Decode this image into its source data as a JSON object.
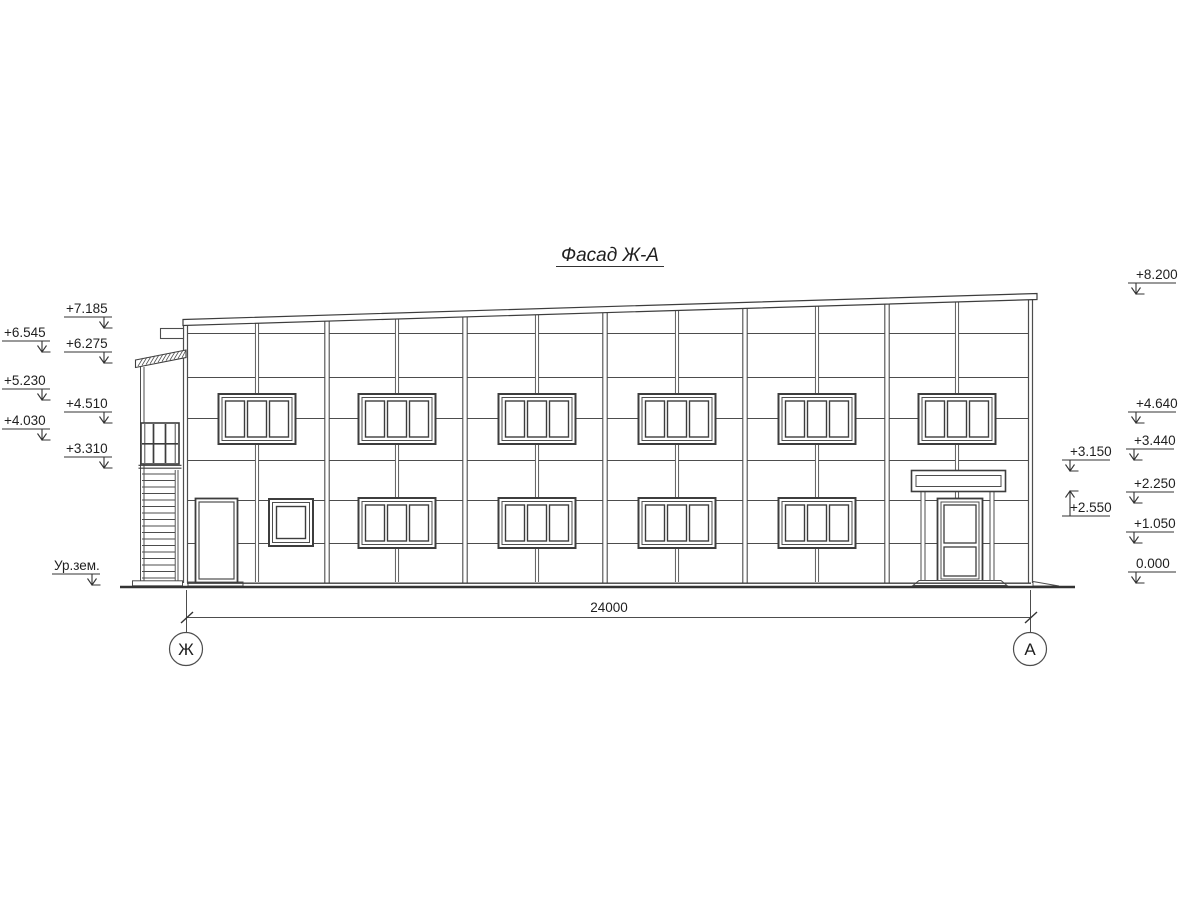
{
  "title": {
    "text": "Фасад Ж-А"
  },
  "left_marks": [
    {
      "label": "+7.185"
    },
    {
      "label": "+6.545"
    },
    {
      "label": "+6.275"
    },
    {
      "label": "+5.230"
    },
    {
      "label": "+4.510"
    },
    {
      "label": "+4.030"
    },
    {
      "label": "+3.310"
    },
    {
      "label": "Ур.зем."
    }
  ],
  "right_marks": [
    {
      "label": "+8.200"
    },
    {
      "label": "+4.640"
    },
    {
      "label": "+3.440"
    },
    {
      "label": "+3.150"
    },
    {
      "label": "+2.250"
    },
    {
      "label": "+2.550"
    },
    {
      "label": "+1.050"
    },
    {
      "label": "0.000"
    }
  ],
  "dimension": {
    "value": "24000"
  },
  "axes": {
    "left": "Ж",
    "right": "А"
  },
  "colors": {
    "line": "#4d4d4d",
    "frame": "#3d3d3d",
    "text": "#1f1f1f",
    "background": "#ffffff"
  }
}
